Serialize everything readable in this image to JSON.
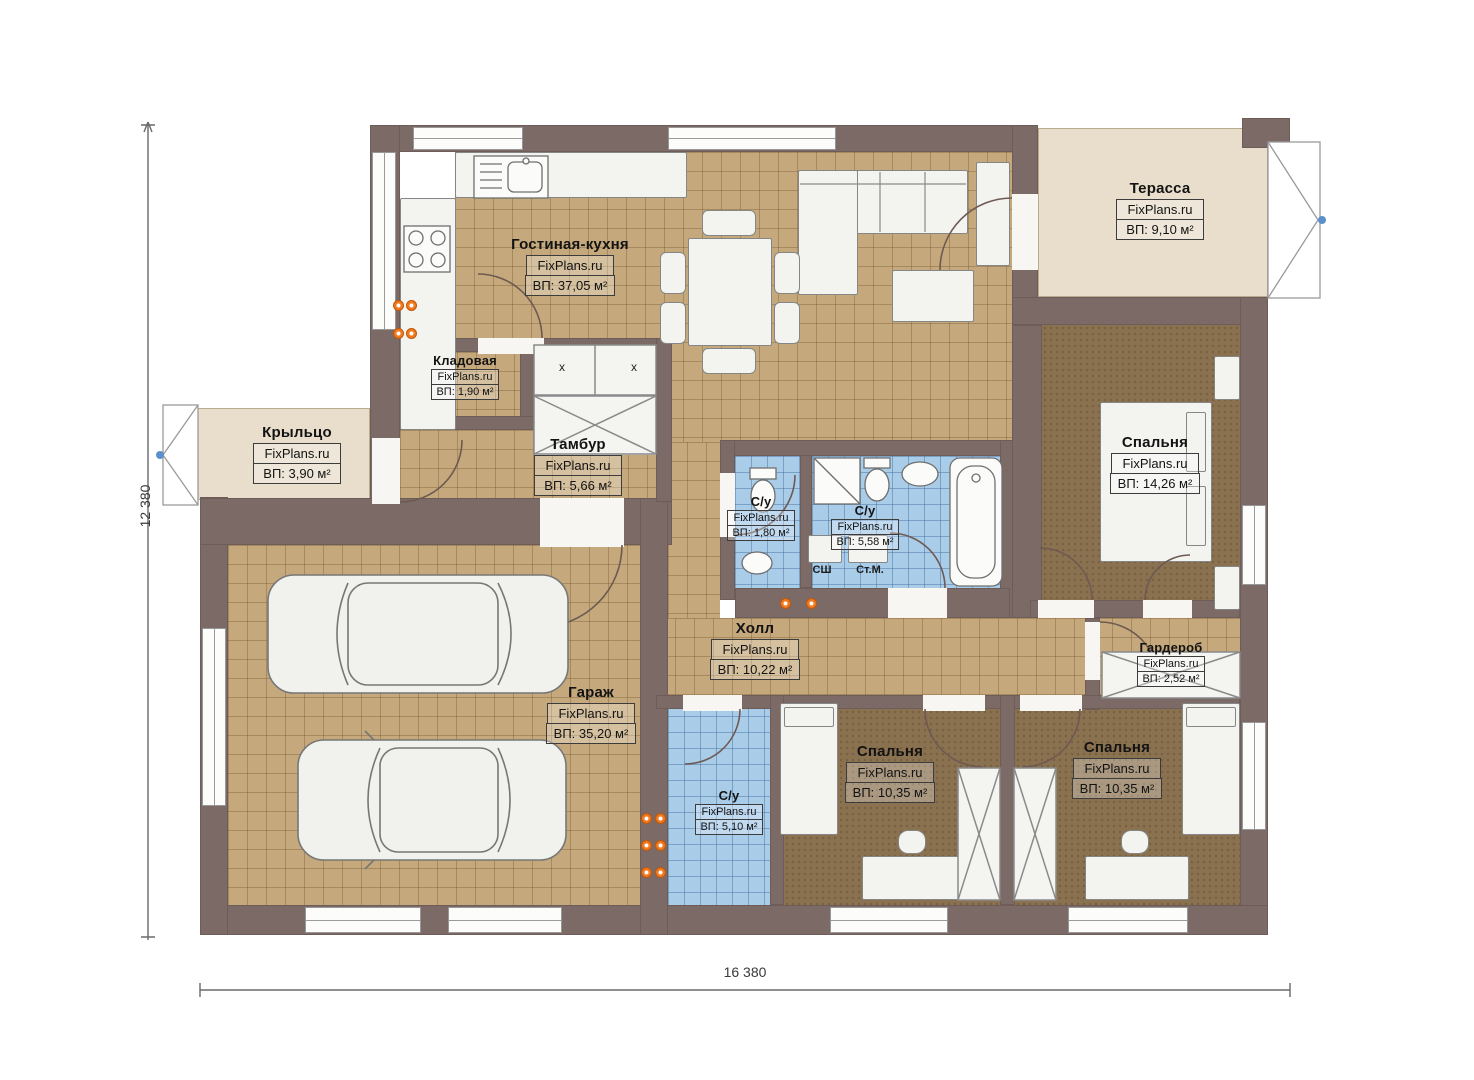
{
  "watermark": "FixPlans.ru",
  "dimensions": {
    "horizontal": "16 380",
    "vertical": "12 380"
  },
  "fixtures": {
    "dryer": "СШ",
    "washer": "Ст.М.",
    "closet_mark": "х"
  },
  "rooms": [
    {
      "id": "terrace",
      "name": "Терасса",
      "area": "ВП: 9,10 м²"
    },
    {
      "id": "living_kitchen",
      "name": "Гостиная-кухня",
      "area": "ВП: 37,05 м²"
    },
    {
      "id": "pantry",
      "name": "Кладовая",
      "area": "ВП: 1,90 м²"
    },
    {
      "id": "porch",
      "name": "Крыльцо",
      "area": "ВП: 3,90 м²"
    },
    {
      "id": "vestibule",
      "name": "Тамбур",
      "area": "ВП: 5,66 м²"
    },
    {
      "id": "bathroom_small",
      "name": "С/у",
      "area": "ВП: 1,80 м²"
    },
    {
      "id": "bathroom_main",
      "name": "С/у",
      "area": "ВП: 5,58 м²"
    },
    {
      "id": "bedroom_master",
      "name": "Спальня",
      "area": "ВП: 14,26 м²"
    },
    {
      "id": "hall",
      "name": "Холл",
      "area": "ВП: 10,22 м²"
    },
    {
      "id": "wardrobe",
      "name": "Гардероб",
      "area": "ВП: 2,52 м²"
    },
    {
      "id": "garage",
      "name": "Гараж",
      "area": "ВП: 35,20 м²"
    },
    {
      "id": "bathroom_lower",
      "name": "С/у",
      "area": "ВП: 5,10 м²"
    },
    {
      "id": "bedroom_left",
      "name": "Спальня",
      "area": "ВП: 10,35 м²"
    },
    {
      "id": "bedroom_right",
      "name": "Спальня",
      "area": "ВП: 10,35 м²"
    }
  ],
  "colors": {
    "wall": "#7b6a66",
    "tile_floor": "#c5a97c",
    "wet_floor": "#a9cce9",
    "bedroom_floor": "#8a7150",
    "terrace_floor": "#e8decb",
    "radiator": "#f07a20",
    "entry_marker": "#5b8fc9"
  }
}
